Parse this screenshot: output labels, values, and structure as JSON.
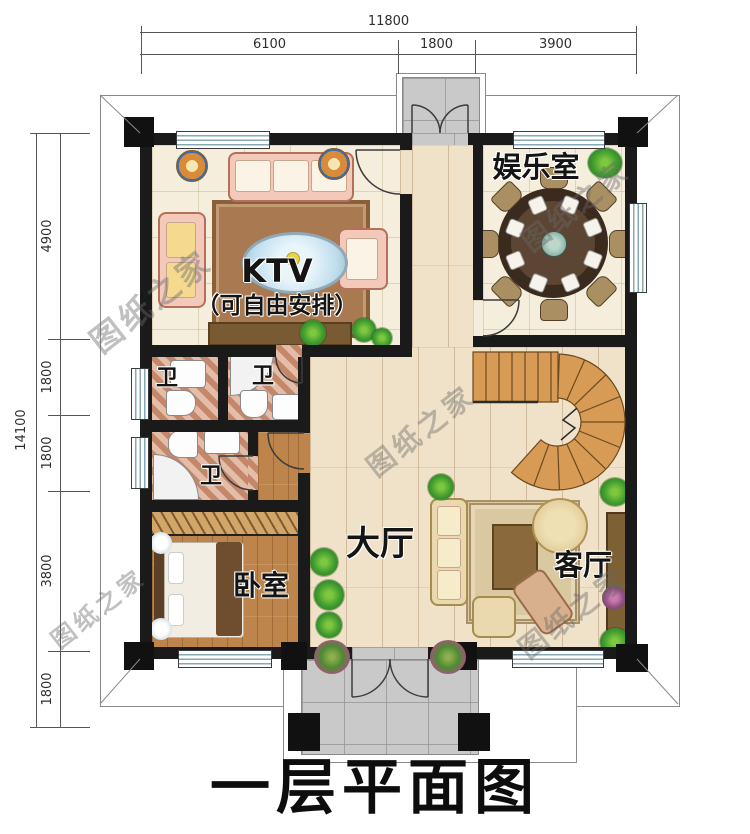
{
  "title": {
    "text": "一层平面图"
  },
  "watermark": {
    "text": "图纸之家"
  },
  "dimensions": {
    "top": {
      "total": "11800",
      "segments": [
        "6100",
        "1800",
        "3900"
      ]
    },
    "left": {
      "total": "14100",
      "segments": [
        "4900",
        "1800",
        "1800",
        "3800",
        "1800"
      ]
    }
  },
  "rooms": {
    "ktv": {
      "name": "KTV",
      "note": "（可自由安排）"
    },
    "entertainment": {
      "name": "娱乐室"
    },
    "bathroom": {
      "name": "卫"
    },
    "bedroom": {
      "name": "卧室"
    },
    "hall": {
      "name": "大厅"
    },
    "living": {
      "name": "客厅"
    }
  },
  "colors": {
    "wall": "#1a1a1a",
    "tile_floor": "#f5eedc",
    "hall_floor": "#f0e2c8",
    "wood_floor": "#bd854b",
    "bath_floor": "#d9a084",
    "porch_floor": "#c9c9c9",
    "stair_wood": "#d79b55",
    "window_stripe": "#86a9b4"
  }
}
